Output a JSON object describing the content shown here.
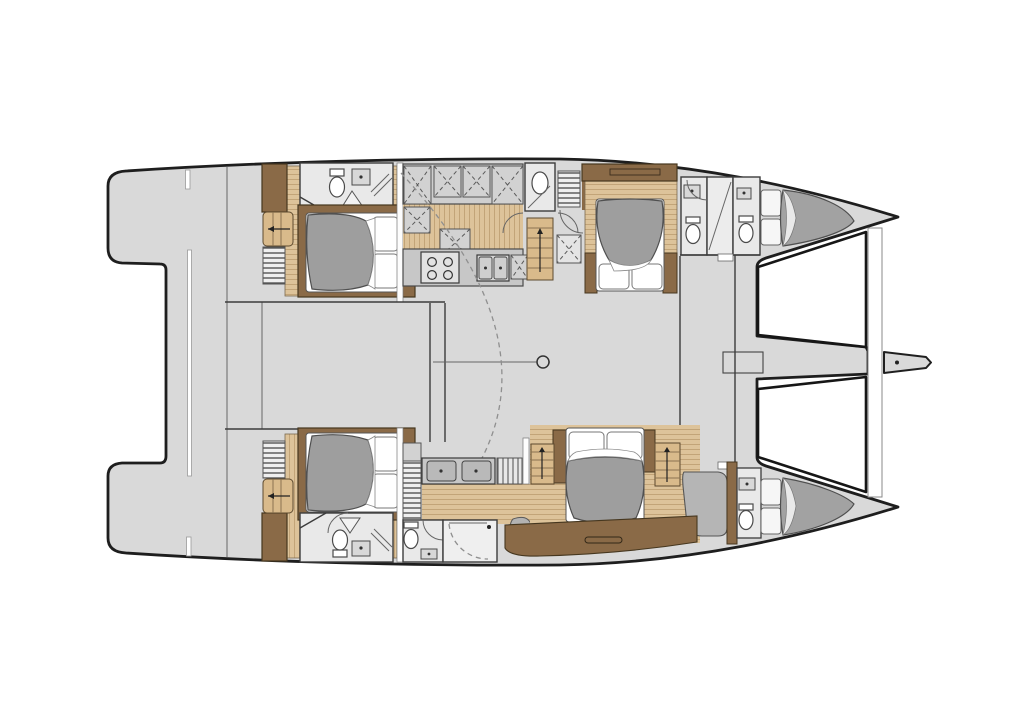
{
  "diagram": {
    "type": "floor-plan",
    "subject": "catamaran-yacht-interior-layout-top-view",
    "orientation": {
      "bow": "right",
      "stern": "left"
    },
    "colors": {
      "paper": "#ffffff",
      "deck": "#d9d9d9",
      "deck_edge": "#1e1e1e",
      "wall": "#3c3c3c",
      "bathroom": "#e9e9e9",
      "fixture": "#ffffff",
      "counter": "#c7c7c7",
      "cabinet": "#d2d2d2",
      "wood_floor": "#ddc39a",
      "wood_stripe": "#bb9c6f",
      "wood_step": "#d9ba8b",
      "wood_dark": "#8a6a47",
      "wood_dark_edge": "#46371f",
      "duvet": "#9e9e9e",
      "duvet_edge": "#4f4f4f",
      "linen": "#ffffff",
      "pouf": "#b3b3b3",
      "dash": "#8f8f8f",
      "shelf_bg": "#efefef",
      "tramp": "#ffffff"
    },
    "inventory": {
      "double_cabins": 4,
      "crew_forepeak_berths": 2,
      "toilets": 7,
      "wash_basins": 9,
      "double_vanity_sinks": 2,
      "galley_burners": 4,
      "galley_sink_bowls": 2,
      "stairways": 4,
      "trampolines": 2,
      "bowsprit": 1,
      "mast_post": 1,
      "stern_platform": 1
    },
    "areas": [
      {
        "id": "stern-platform"
      },
      {
        "id": "salon-bridgedeck"
      },
      {
        "id": "galley"
      },
      {
        "id": "day-head"
      },
      {
        "id": "port-aft-cabin-ensuite"
      },
      {
        "id": "port-forward-cabin"
      },
      {
        "id": "forward-bathrooms"
      },
      {
        "id": "port-forepeak-crew-berth"
      },
      {
        "id": "starboard-aft-cabin-ensuite"
      },
      {
        "id": "owner-bathroom-double-vanity"
      },
      {
        "id": "owner-cabin"
      },
      {
        "id": "starboard-forepeak-crew-berth"
      },
      {
        "id": "foredeck-beam-and-trampolines"
      },
      {
        "id": "bowsprit"
      }
    ]
  }
}
